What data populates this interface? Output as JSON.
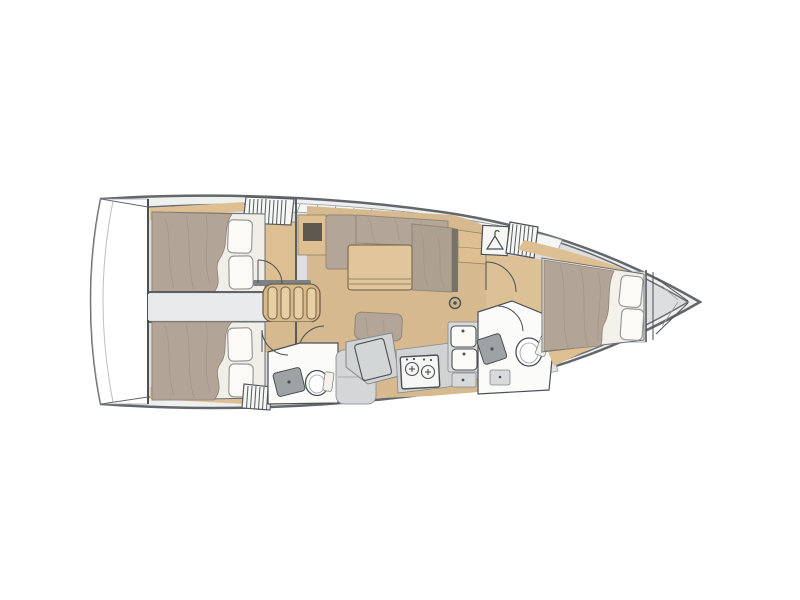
{
  "plan": {
    "subject": "sailing-yacht-interior-floor-plan",
    "view": "overhead",
    "bow_direction": "right",
    "cabins_count": 3,
    "heads_count": 2,
    "areas": [
      "swim-platform",
      "aft-port-cabin",
      "aft-starboard-cabin",
      "companionway-steps",
      "saloon",
      "nav-station",
      "galley",
      "aft-head",
      "forward-head",
      "hanging-locker",
      "forward-cabin",
      "anchor-locker"
    ],
    "icons": {
      "hanging-locker-icon": "hanger-triangle-with-hook",
      "stove-icon": "two-burner-circles",
      "sink-icon": "basin-with-faucet-dot",
      "toilet-icon": "oval-bowl",
      "mast-icon": "ring-with-center-dot",
      "vent-locker-icon": "striped-slats"
    }
  },
  "colors": {
    "canvas": "#ffffff",
    "hullStroke": "#63676a",
    "deckBand": "#eef0f0",
    "innerStroke": "#6a6e72",
    "interior": "#dcdee0",
    "transom": "#ffffff",
    "transomSeam": "#bcbfc0",
    "bulkhead": "#4b5054",
    "band": "#f4f5f5",
    "bandStroke": "#9a9da0",
    "bandDivider": "#84888b",
    "bottomBand": "#e2e3e4",
    "corridor": "#e9eaeb",
    "floorWood": "#d6b98e",
    "floorWoodFwd": "#dcc096",
    "furnitureWood": "#ddbf92",
    "woodStroke": "#8f8164",
    "tableWood": "#e2c69b",
    "tableStroke": "#7d6f52",
    "stepRung": "#e7cea3",
    "stepBase": "#d8b98c",
    "stepStroke": "#6f6049",
    "hatch": "#f6f6f5",
    "hatchStroke": "#55595d",
    "hatchBar": "#7d8184",
    "mattress": "#b2a597",
    "mattressDeep": "#aca091",
    "mattressStroke": "#8d8073",
    "wrinkle": "#9c8f80",
    "bedBase": "#f1eee7",
    "bedding": "#fbfaf7",
    "pillowStroke": "#97999b",
    "cushion": "#b3a698",
    "cushionStroke": "#938677",
    "cushionDark": "#77726a",
    "counter": "#d0d2d3",
    "counterStroke": "#85898c",
    "navTop": "#d3d6d7",
    "fixtureWhite": "#fbfbfa",
    "fixtureStroke": "#4b5054",
    "sinkDark": "#9da2a4",
    "applianceWhite": "#f6f6f4",
    "benchGray": "#d4d6d7",
    "grayBox": "#d7d9da",
    "lineDark": "#4b5054",
    "lineLight": "#9a9da0",
    "doorArc": "#4b5054",
    "mastWood": "#d0b58c",
    "sheetWhite": "#f3f1ea",
    "darkOpening": "#5f584e",
    "shelfWhite": "#f4f5f5"
  }
}
